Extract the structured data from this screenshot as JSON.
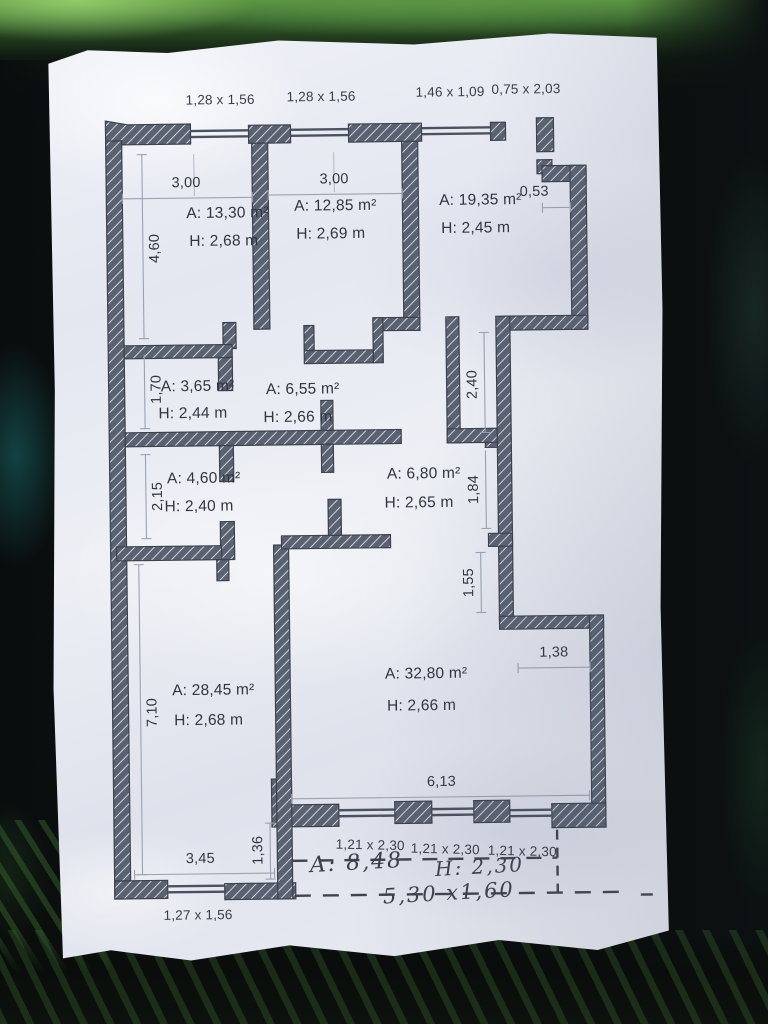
{
  "plan": {
    "top_openings": [
      "1,28 x 1,56",
      "1,28 x 1,56",
      "1,46 x 1,09",
      "0,75 x 2,03"
    ],
    "dims": {
      "room1_width": "3,00",
      "room2_width": "3,00",
      "niche_top": "0,53",
      "left_1": "4,60",
      "left_2": "1,70",
      "left_3": "2,15",
      "left_4": "7,10",
      "right_1": "2,40",
      "right_2": "1,84",
      "right_3": "1,55",
      "right_4": "1,38",
      "bottom_width": "6,13",
      "bottom_left_width": "3,45",
      "step_offset": "1,36",
      "window_bottom_left": "1,27 x 1,56",
      "balcony_doors": [
        "1,21 x 2,30",
        "1,21 x 2,30",
        "1,21 x 2,30"
      ]
    },
    "rooms": [
      {
        "area": "A: 13,30 m²",
        "height": "H: 2,68 m"
      },
      {
        "area": "A: 12,85 m²",
        "height": "H: 2,69 m"
      },
      {
        "area": "A: 19,35 m²",
        "height": "H: 2,45 m"
      },
      {
        "area": "A: 3,65 m²",
        "height": "H: 2,44 m"
      },
      {
        "area": "A: 6,55 m²",
        "height": "H: 2,66 m"
      },
      {
        "area": "A: 4,60 m²",
        "height": "H: 2,40 m"
      },
      {
        "area": "A: 6,80 m²",
        "height": "H: 2,65 m"
      },
      {
        "area": "A: 28,45 m²",
        "height": "H: 2,68 m"
      },
      {
        "area": "A: 32,80 m²",
        "height": "H: 2,66 m"
      }
    ],
    "handwritten": {
      "area": "A: 8,48",
      "height": "H: 2,30",
      "size": "5,30 x1,60"
    },
    "colors": {
      "wall": "#5a6170",
      "hatch_line": "#cfd3dc",
      "dimension": "#9aa2b2",
      "ink": "#30353f"
    }
  }
}
